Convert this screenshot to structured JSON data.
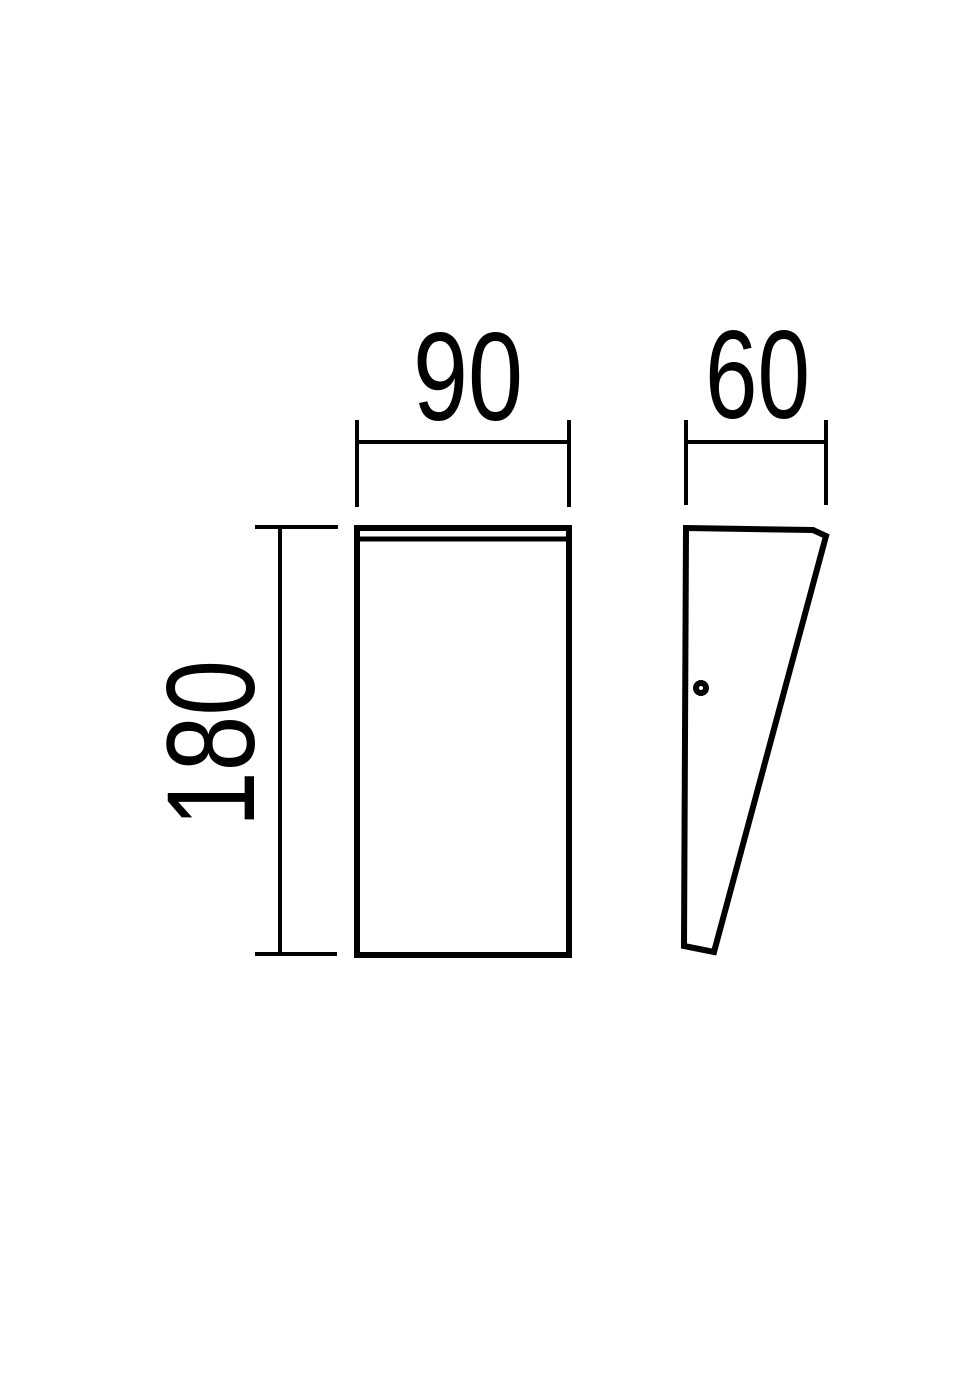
{
  "canvas": {
    "background_color": "#ffffff",
    "stroke_color": "#000000"
  },
  "drawing": {
    "dimensions": {
      "width": {
        "label": "90",
        "value": 90
      },
      "depth": {
        "label": "60",
        "value": 60
      },
      "height": {
        "label": "180",
        "value": 180
      }
    }
  }
}
